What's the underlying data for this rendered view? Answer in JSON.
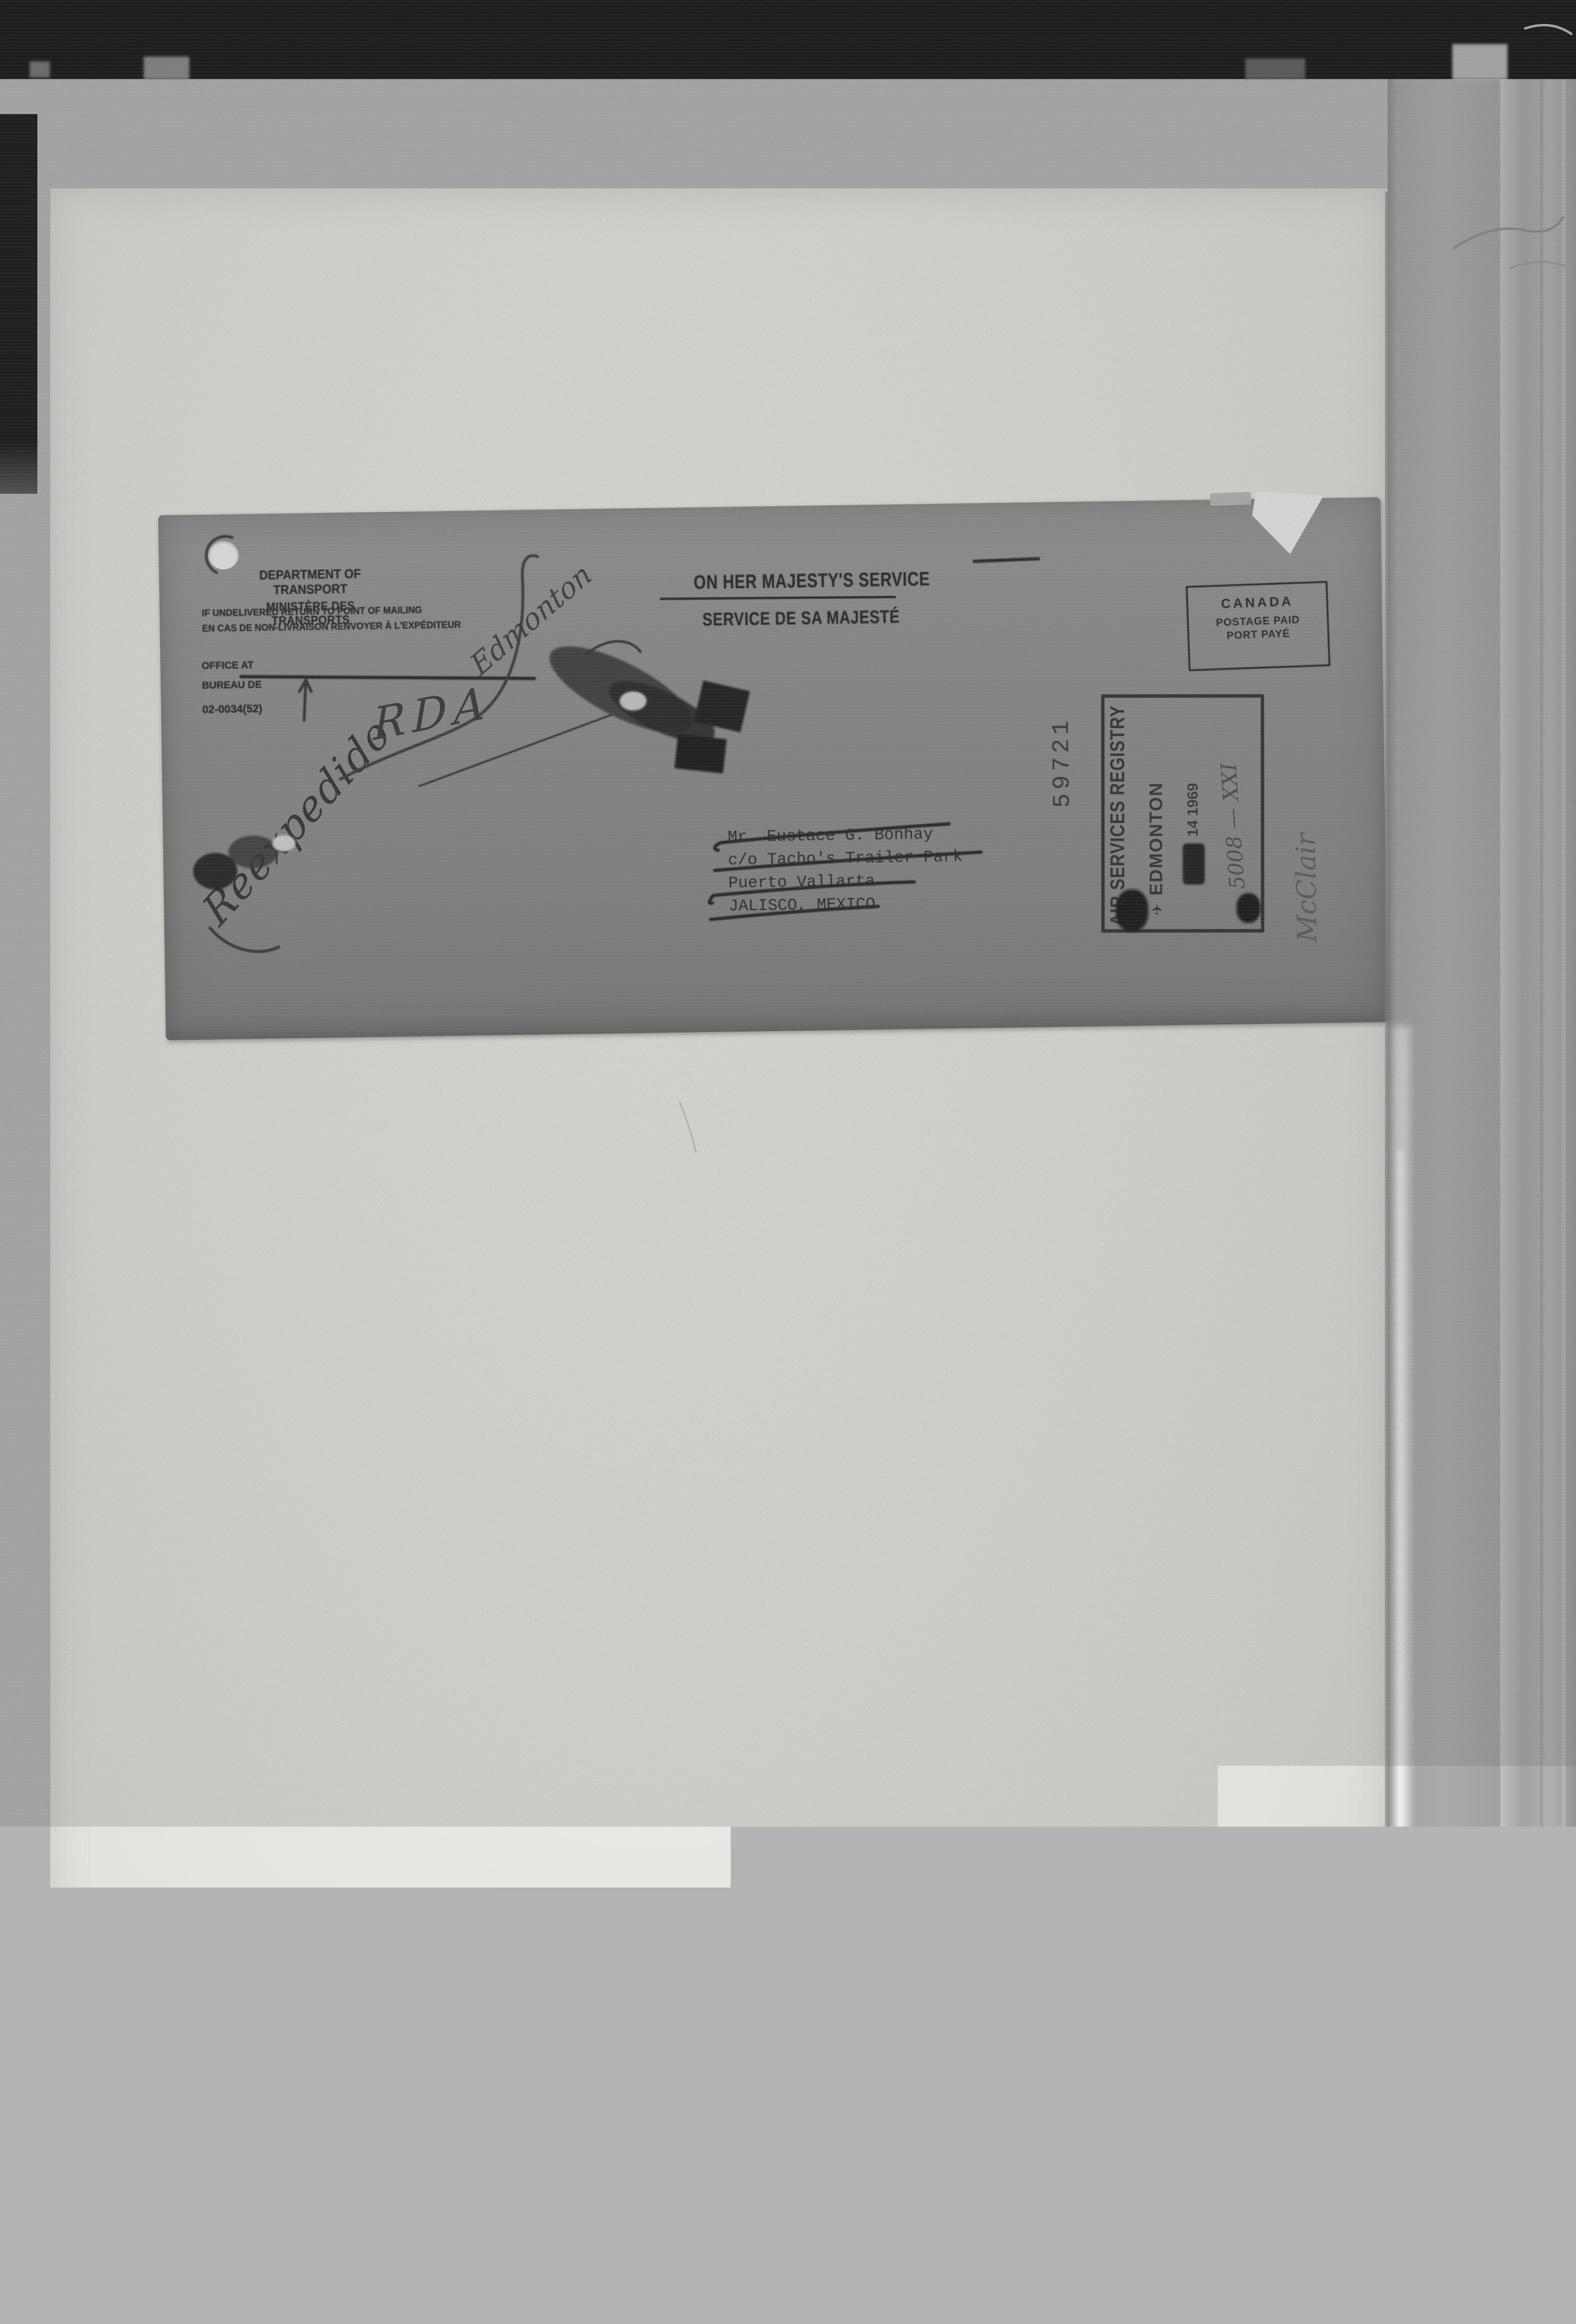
{
  "envelope": {
    "sender": {
      "dept_en": "DEPARTMENT OF TRANSPORT",
      "dept_fr": "MINISTÈRE DES TRANSPORTS",
      "return_en": "IF UNDELIVERED RETURN TO POINT OF MAILING",
      "return_fr": "EN CAS DE NON-LIVRAISON RENVOYER À L'EXPÉDITEUR",
      "office_at": "OFFICE AT",
      "bureau_de": "BUREAU DE",
      "form_number": "02-0034(52)"
    },
    "ohms": {
      "english": "ON HER MAJESTY'S SERVICE",
      "french": "SERVICE DE SA MAJESTÉ"
    },
    "postage_box": {
      "country": "CANADA",
      "line2": "POSTAGE PAID",
      "line3": "PORT PAYÉ"
    },
    "registry_number": "59721",
    "registry_stamp": {
      "line1": "AIR SERVICES REGISTRY",
      "plane_icon": "✈",
      "line2": "EDMONTON",
      "date": "14 1969",
      "file_annotation": "5008 — XXI"
    },
    "address": [
      "Mr. Eustace G. Bonhay",
      "c/o Tacho's Trailer Park",
      "Puerto Vallarta",
      "JALISCO, MEXICO"
    ],
    "handwriting": {
      "script_word": "Reexpedido",
      "city": "Edmonton",
      "initials": "RDA",
      "signature": "McClair"
    }
  },
  "colors": {
    "envelope_grey": "#8d8d8d",
    "paper_white": "#eae9e5",
    "ink_black": "#1e1e1e",
    "film_border": "#0a0a0a"
  }
}
